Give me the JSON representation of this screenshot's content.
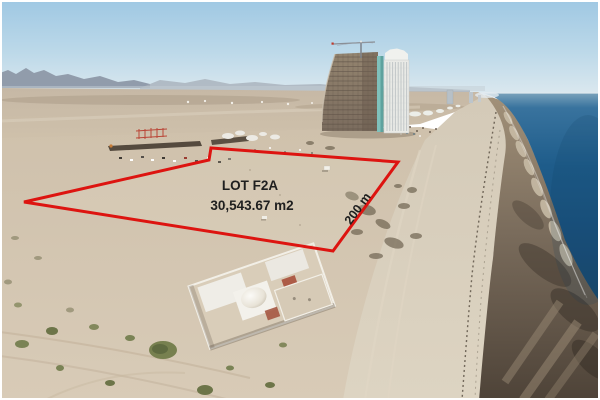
{
  "overlay": {
    "lot_name": "LOT F2A",
    "lot_area": "30,543.67 m2",
    "side_length": "200 m",
    "boundary_color": "#dd1410",
    "label_color": "#1f1f1f"
  },
  "scene": {
    "description": "Aerial drone photo of a beachfront desert lot outlined in red beside a high-rise condo tower under construction, with a domed white villa in the foreground, wide beach, tidal flats and deep blue sea to the right, desert plain and distant mountains behind.",
    "landmarks": [
      "red lot boundary polygon",
      "high-rise under construction with tower crane",
      "finished white tower",
      "white villa with dome",
      "construction site with trenches and vehicles",
      "beach and tidal flats",
      "sea",
      "desert plain",
      "distant mountains"
    ]
  },
  "colors": {
    "sky": "#a4cbe5",
    "sea": "#1d5886",
    "desert_sand": "#d2c5b0",
    "beach_sand": "#d9d0bf",
    "wet_sand": "#6e6254",
    "shrub_green": "#77804f"
  }
}
